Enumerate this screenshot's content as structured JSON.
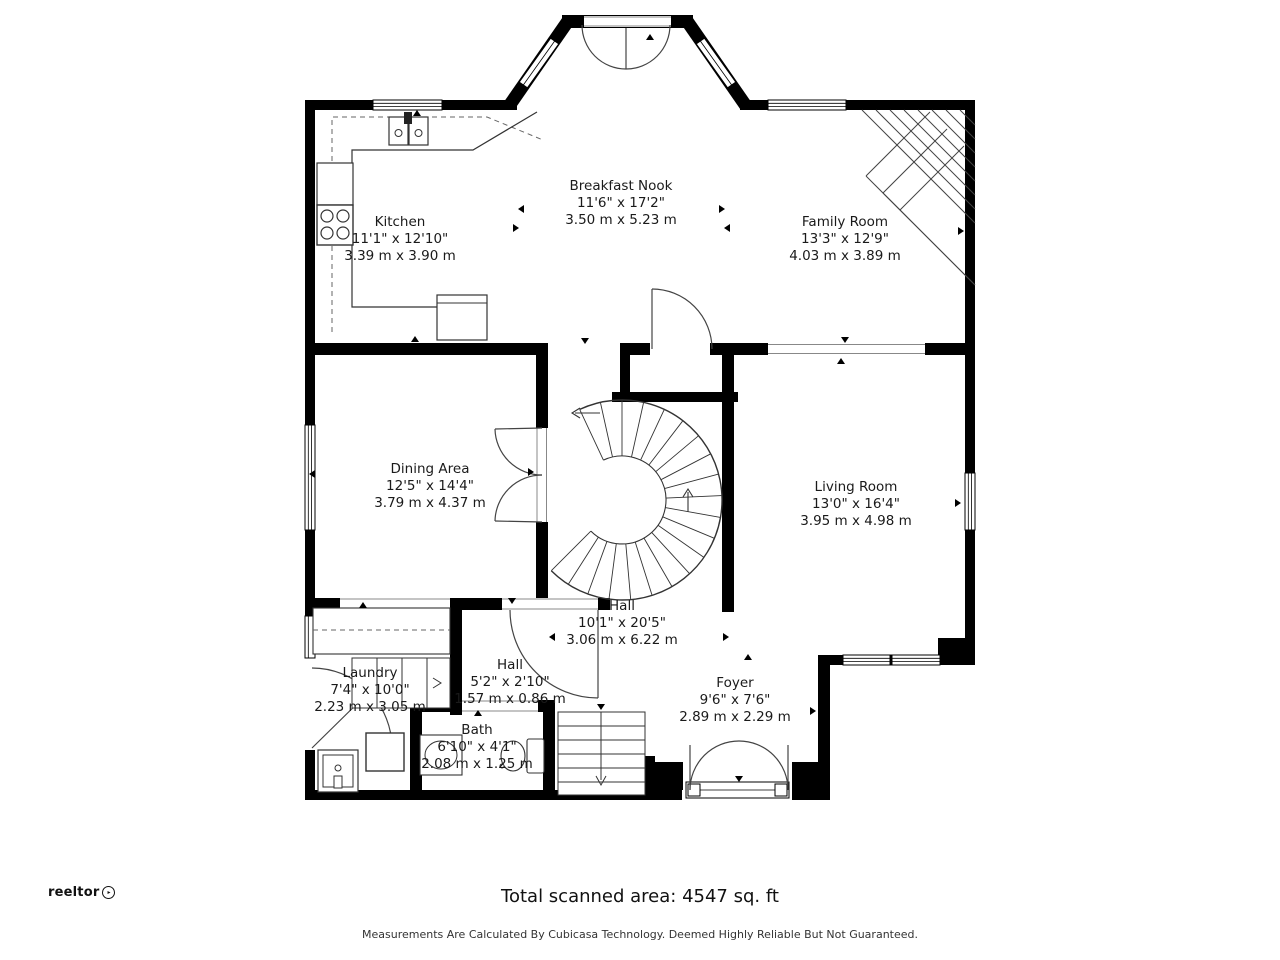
{
  "rooms": [
    {
      "name": "Kitchen",
      "imperial": "11'1\" x 12'10\"",
      "metric": "3.39 m x 3.90 m"
    },
    {
      "name": "Breakfast Nook",
      "imperial": "11'6\" x 17'2\"",
      "metric": "3.50 m x 5.23 m"
    },
    {
      "name": "Family Room",
      "imperial": "13'3\" x 12'9\"",
      "metric": "4.03 m x 3.89 m"
    },
    {
      "name": "Dining Area",
      "imperial": "12'5\" x 14'4\"",
      "metric": "3.79 m x 4.37 m"
    },
    {
      "name": "Living Room",
      "imperial": "13'0\" x 16'4\"",
      "metric": "3.95 m x 4.98 m"
    },
    {
      "name": "Hall",
      "imperial": "10'1\" x 20'5\"",
      "metric": "3.06 m x 6.22 m"
    },
    {
      "name": "Laundry",
      "imperial": "7'4\" x 10'0\"",
      "metric": "2.23 m x 3.05 m"
    },
    {
      "name": "Hall",
      "imperial": "5'2\" x 2'10\"",
      "metric": "1.57 m x 0.86 m"
    },
    {
      "name": "Bath",
      "imperial": "6'10\" x 4'1\"",
      "metric": "2.08 m x 1.25 m"
    },
    {
      "name": "Foyer",
      "imperial": "9'6\" x 7'6\"",
      "metric": "2.89 m x 2.29 m"
    }
  ],
  "footer": {
    "total_area": "Total scanned area: 4547 sq. ft",
    "disclaimer": "Measurements Are Calculated By Cubicasa Technology. Deemed Highly Reliable But Not Guaranteed.",
    "brand": "reeltor"
  },
  "colors": {
    "wall": "#000000",
    "floor": "#ffffff",
    "text": "#1a1a1a"
  }
}
